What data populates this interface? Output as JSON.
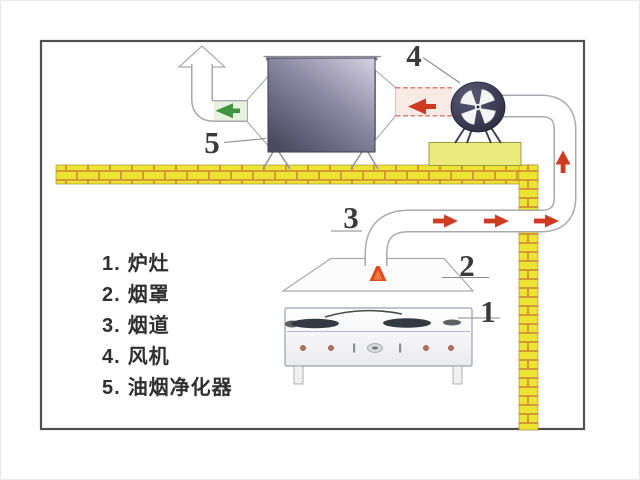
{
  "diagram": {
    "callouts": {
      "stove": "1",
      "hood": "2",
      "flue": "3",
      "fan": "4",
      "purifier": "5"
    },
    "legend": {
      "items": [
        {
          "num": "1.",
          "label": "炉灶"
        },
        {
          "num": "2.",
          "label": "烟罩"
        },
        {
          "num": "3.",
          "label": "烟道"
        },
        {
          "num": "4.",
          "label": "风机"
        },
        {
          "num": "5.",
          "label": "油烟净化器"
        }
      ]
    },
    "arrows": {
      "clean_air_out": "up-arrow-outline",
      "purified_flow": "green-left-arrow",
      "fan_suction": "red-left-arrow",
      "hood_updraft": "orange-up-arrow",
      "flue_flow": "red-right-arrows",
      "riser_flow": "red-up-arrow"
    },
    "colors": {
      "frame": "#4f4f4f",
      "duct_outline": "#a8a8b0",
      "brick_yellow": "#ece432",
      "brick_mortar": "#d08834",
      "arrow_red": "#cf3b22",
      "arrow_green": "#3f9540",
      "flame_orange": "#e2491f",
      "green_duct_fill": "#e8f3dd",
      "red_duct_fill": "#faeae6",
      "purifier_light": "#d6d2e4",
      "purifier_mid": "#8e8ba4",
      "purifier_dark": "#4a4960",
      "fan_mid": "#5b5a75",
      "fan_dark": "#26253a",
      "fan_base_yellow": "#eaea7d"
    }
  }
}
